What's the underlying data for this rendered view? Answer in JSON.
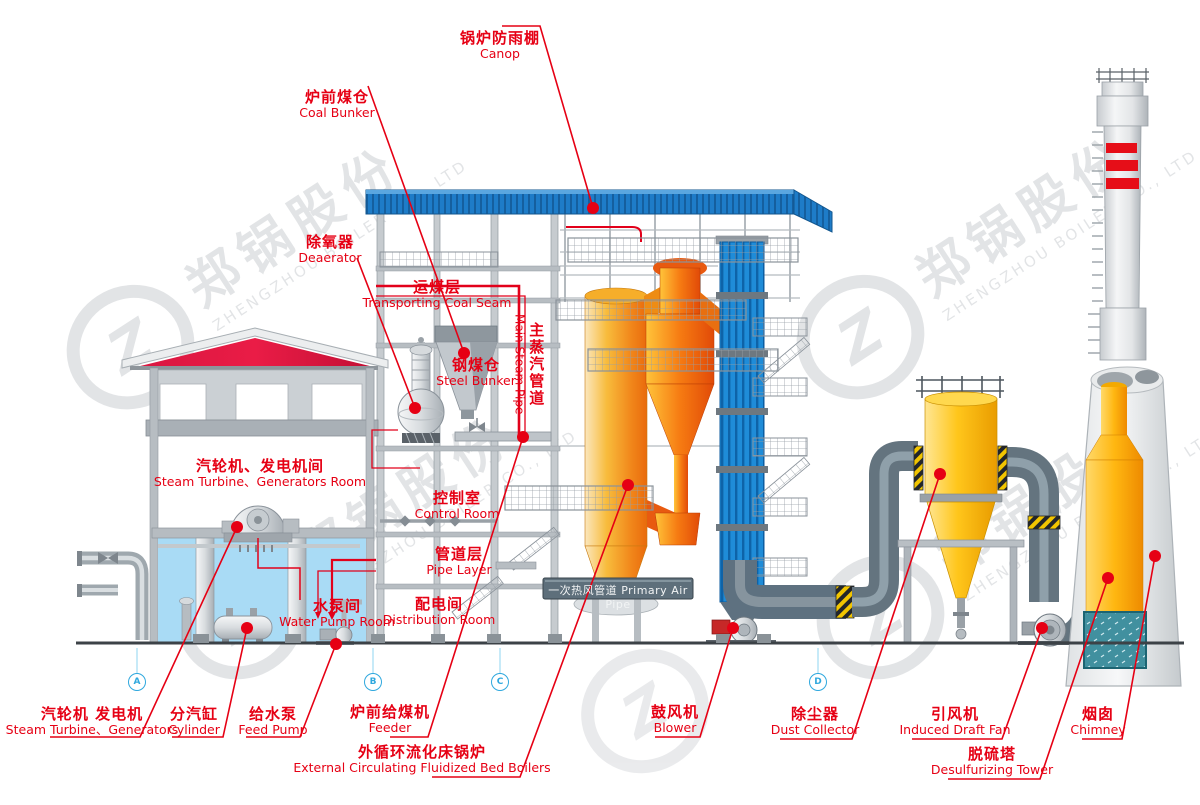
{
  "watermark": {
    "zh": "郑锅股份",
    "en": "ZHENGZHOU BOILER CO., LTD"
  },
  "section_markers": {
    "a": "A",
    "b": "B",
    "c": "C",
    "d": "D"
  },
  "labels": {
    "canopy": {
      "zh": "锅炉防雨棚",
      "en": "Canop"
    },
    "coal_bunker": {
      "zh": "炉前煤仓",
      "en": "Coal Bunker"
    },
    "deaerator": {
      "zh": "除氧器",
      "en": "Deaerator"
    },
    "coal_seam": {
      "zh": "运煤层",
      "en": "Transporting Coal Seam"
    },
    "steel_bunker": {
      "zh": "钢煤仓",
      "en": "Steel Bunker"
    },
    "main_steam_pipe": {
      "zh": "主蒸汽管道",
      "en": "Main Steam Pipe"
    },
    "turbine_room": {
      "zh": "汽轮机、发电机间",
      "en": "Steam Turbine、Generators Room"
    },
    "control_room": {
      "zh": "控制室",
      "en": "Control Room"
    },
    "pipe_layer": {
      "zh": "管道层",
      "en": "Pipe Layer"
    },
    "water_pump_room": {
      "zh": "水泵间",
      "en": "Water Pump Room"
    },
    "distribution_room": {
      "zh": "配电间",
      "en": "Distribution Room"
    },
    "primary_air_pipe": {
      "zh": "一次热风管道",
      "en": "Primary Air Pipe"
    },
    "turbine_generators": {
      "zh": "汽轮机 发电机",
      "en": "Steam Turbine、Generators"
    },
    "cylinder": {
      "zh": "分汽缸",
      "en": "Cylinder"
    },
    "feed_pump": {
      "zh": "给水泵",
      "en": "Feed Pump"
    },
    "feeder": {
      "zh": "炉前给煤机",
      "en": "Feeder"
    },
    "ecfb": {
      "zh": "外循环流化床锅炉",
      "en": "External Circulating Fluidized Bed Boilers"
    },
    "blower": {
      "zh": "鼓风机",
      "en": "Blower"
    },
    "dust_collector": {
      "zh": "除尘器",
      "en": "Dust Collector"
    },
    "idf": {
      "zh": "引风机",
      "en": "Induced Draft Fan"
    },
    "desulfurizing_tower": {
      "zh": "脱硫塔",
      "en": "Desulfurizing Tower"
    },
    "chimney": {
      "zh": "烟囱",
      "en": "Chimney"
    }
  },
  "colors": {
    "label_red": "#e60014",
    "canopy_blue": "#1e7cc8",
    "pass_blue": "#1f8cd8",
    "furnace_orange": "#f1861a",
    "collector_gold": "#ffc61b",
    "marker_blue": "#2fa8de"
  }
}
